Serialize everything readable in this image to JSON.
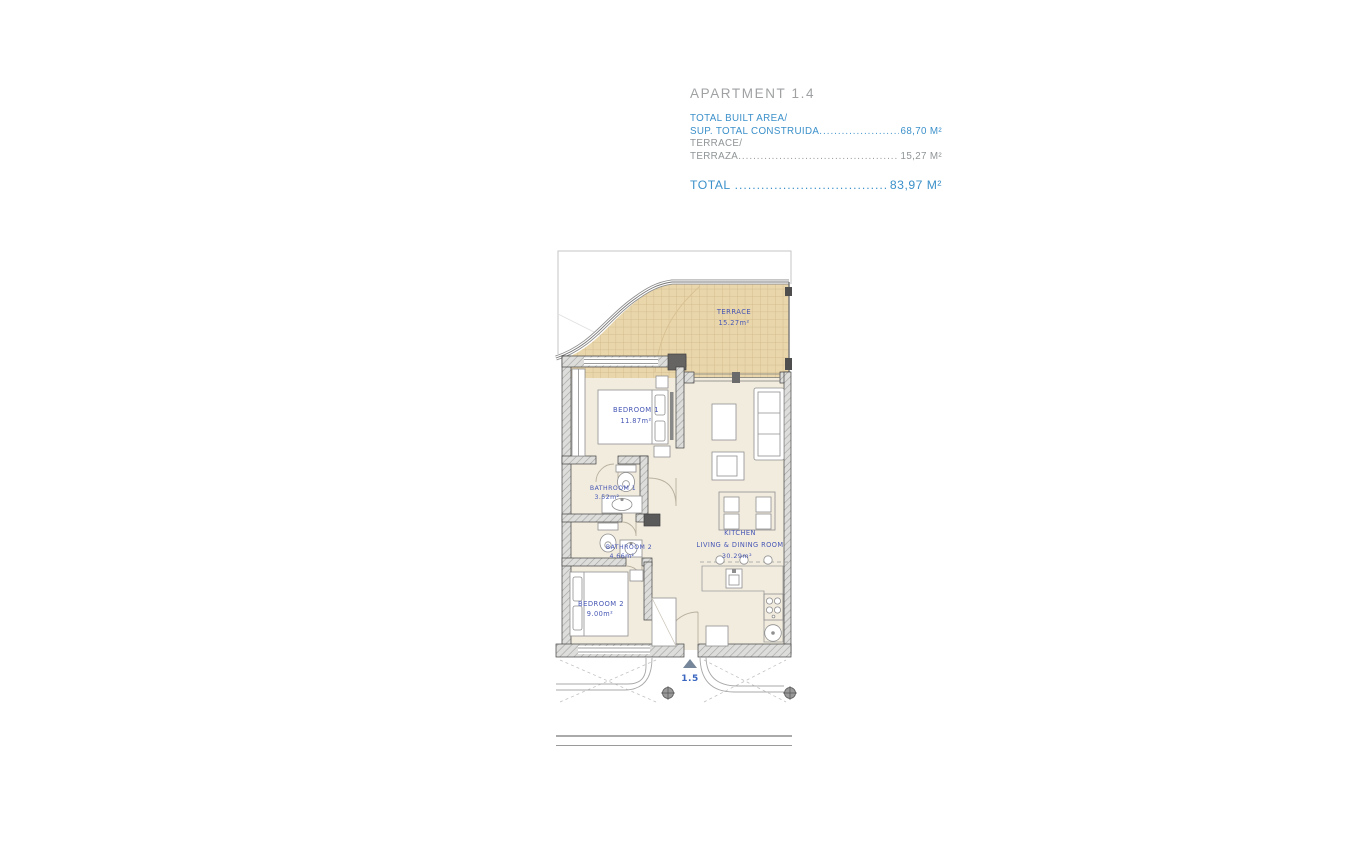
{
  "header": {
    "title": "APARTMENT 1.4",
    "rows": [
      {
        "line1": "TOTAL BUILT AREA/",
        "line2": "SUP. TOTAL CONSTRUIDA",
        "value": "68,70 M²",
        "style": "accent"
      },
      {
        "line1": "TERRACE/",
        "line2": "TERRAZA",
        "value": "15,27 M²",
        "style": "muted"
      }
    ],
    "total": {
      "label": "TOTAL",
      "value": "83,97 M²"
    },
    "leader_dots": "................................................................................."
  },
  "plan": {
    "rooms": {
      "terrace": {
        "name": "TERRACE",
        "area": "15.27m²"
      },
      "bedroom1": {
        "name": "BEDROOM 1",
        "area": "11.87m²"
      },
      "bathroom1": {
        "name": "BATHROOM 1",
        "area": "3.52m²"
      },
      "bathroom2": {
        "name": "BATHROOM 2",
        "area": "4.66m²"
      },
      "bedroom2": {
        "name": "BEDROOM 2",
        "area": "9.00m²"
      },
      "kitchen": {
        "name_line1": "KITCHEN",
        "name_line2": "LIVING  &  DINING  ROOM",
        "area": "30.29m²"
      }
    },
    "entrance": {
      "label": "1.5"
    }
  },
  "colors": {
    "accent_blue": "#3b90ca",
    "label_blue": "#4656b4",
    "title_gray": "#9fa1a3",
    "muted_gray": "#8f9496",
    "terrace_tan": "#e9d6ab",
    "floor_beige": "#f2ecdf"
  }
}
